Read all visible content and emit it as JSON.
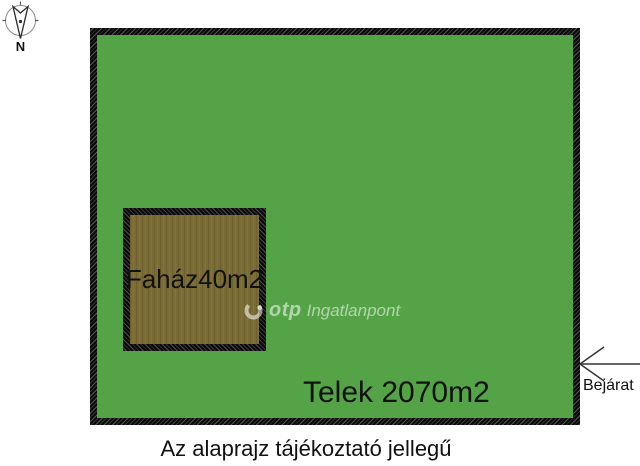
{
  "colors": {
    "plot_green": "#55a347",
    "house_brown": "#7b6c35",
    "ink": "#111111",
    "watermark": "rgba(255,255,255,0.55)"
  },
  "compass": {
    "north_label": "N"
  },
  "plot": {
    "label": "Telek 2070m2"
  },
  "house": {
    "label": "Faház40m2"
  },
  "watermark": {
    "brand": "otp",
    "suffix": "Ingatlanpont"
  },
  "entrance": {
    "label": "Bejárat"
  },
  "caption": {
    "text": "Az alaprajz tájékoztató jellegű"
  }
}
